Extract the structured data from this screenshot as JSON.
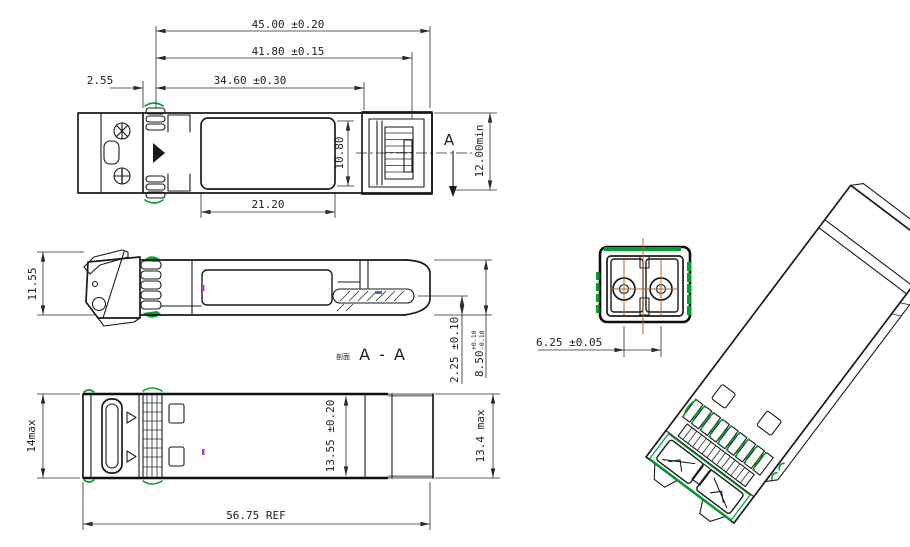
{
  "colors": {
    "line": "#1a1a1a",
    "emi_gasket_green": "#00a12b",
    "centerline_orange": "#b5651d",
    "mark_purple": "#b13bd6",
    "mark_blue": "#3a6fd8",
    "connector_gray": "#8f8f8f",
    "background": "#ffffff"
  },
  "views": {
    "top": {
      "dims": {
        "d45": "45.00 ±0.20",
        "d418": "41.80 ±0.15",
        "d346": "34.60 ±0.30",
        "d255": "2.55",
        "d212": "21.20",
        "d108": "10.80",
        "d12min": "12.00min",
        "section_letter": "A"
      }
    },
    "side": {
      "dims": {
        "d1155": "11.55",
        "d225": "2.25 ±0.10",
        "d850": "8.50",
        "d850_tol_plus": "+0.10",
        "d850_tol_minus": "-0.10"
      },
      "section_caption_prefix": "剖面",
      "section_caption": "A - A"
    },
    "bottom": {
      "dims": {
        "d14": "14max",
        "d1355": "13.55 ±0.20",
        "d134": "13.4 max",
        "d5675": "56.75 REF"
      }
    },
    "front": {
      "dims": {
        "d625": "6.25 ±0.05"
      }
    }
  }
}
